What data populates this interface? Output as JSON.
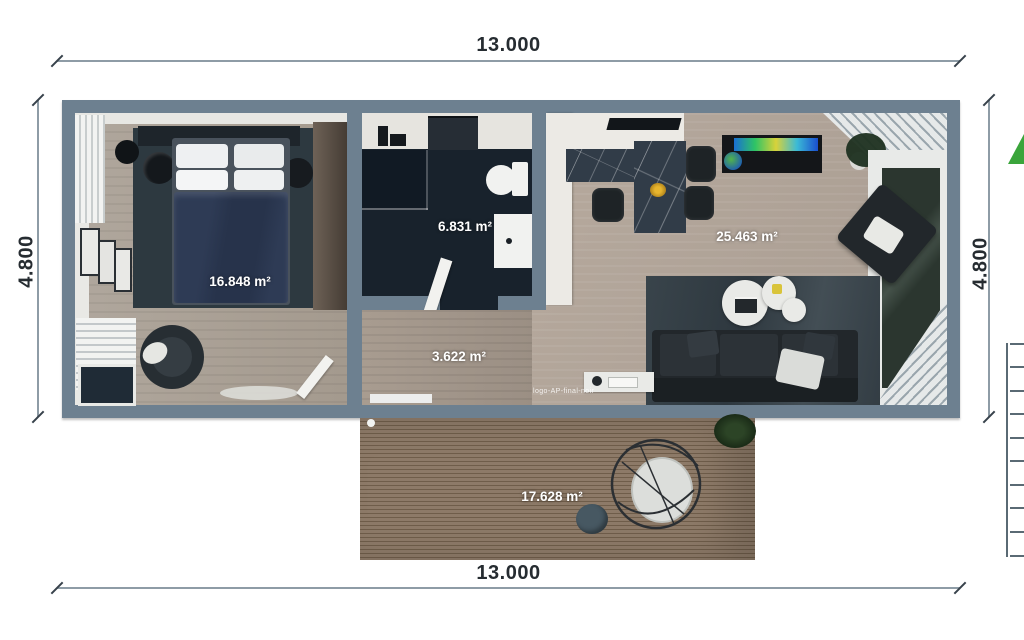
{
  "drawing": {
    "type": "floor-plan-render",
    "dimensions": {
      "width_top": "13.000",
      "width_bottom": "13.000",
      "height_left": "4.800",
      "height_right": "4.800"
    },
    "rooms": [
      {
        "name": "bedroom",
        "area": "16.848 m²"
      },
      {
        "name": "bathroom",
        "area": "6.831 m²"
      },
      {
        "name": "hallway",
        "area": "3.622 m²"
      },
      {
        "name": "living-kitchen",
        "area": "25.463 m²"
      },
      {
        "name": "terrace-deck",
        "area": "17.628 m²"
      }
    ],
    "annotations": {
      "texture_placeholder": "logo-AP-final-noir"
    },
    "colors": {
      "wall": "#6d8090",
      "accent_green": "#3aa53b",
      "bathroom_floor": "#18222c",
      "wood_floor": "#aba399",
      "deck_wood": "#8d7a68",
      "area_label_text": "#ffffff",
      "dimension_text": "#262c31"
    }
  }
}
